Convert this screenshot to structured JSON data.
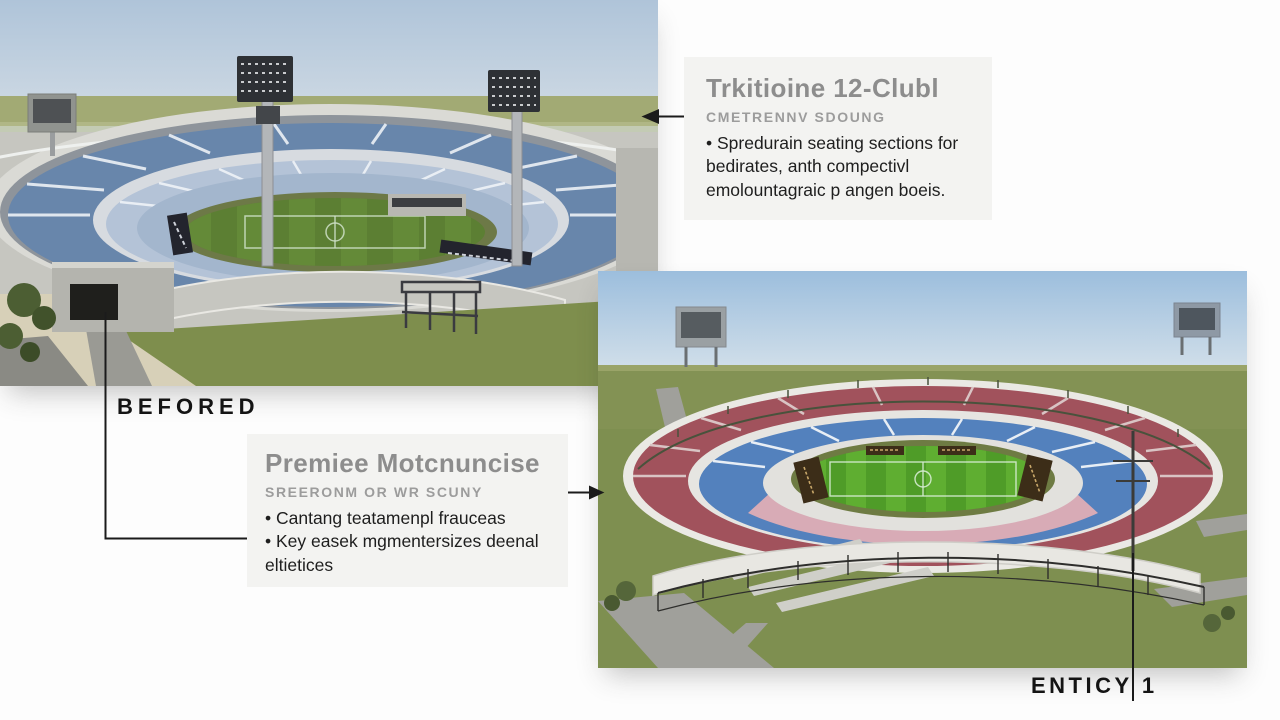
{
  "meta": {
    "kind": "stadium-before-after-infographic"
  },
  "labels": {
    "before": "BEFORED",
    "after": "ENTICY 1"
  },
  "callouts": {
    "top": {
      "title": "Trkitioine 12-Clubl",
      "subtitle": "CMETRENNV SDOUNG",
      "bullets": [
        "• Spredurain seating sections for bedirates, anth compectivl emolountagraic p angen boeis."
      ]
    },
    "middle": {
      "title": "Premiee Motcnuncise",
      "subtitle": "SREERONM OR WR SCUNY",
      "bullets": [
        "• Cantang teatamenpl frauceas",
        "• Key easek mgmentersizes deenal eltietices"
      ]
    }
  },
  "colors": {
    "background": "#fdfdfd",
    "callout_bg": "#f3f3f1",
    "callout_title": "#8d8d8d",
    "callout_subtitle": "#9c9c9c",
    "body_text": "#1e1e1e",
    "label_text": "#141414",
    "connector_line": "#1b1b1b",
    "before_sky": "#afc4d9",
    "before_upper_seats": "#6886ab",
    "before_lower_seats": "#b4c3d7",
    "after_upper_tier": "#a1525c",
    "after_lower_tier": "#5381bd",
    "after_front_tier_pink": "#d8abb6",
    "pitch_green": "#4f9c28",
    "lawn_olive": "#7e8f50"
  }
}
